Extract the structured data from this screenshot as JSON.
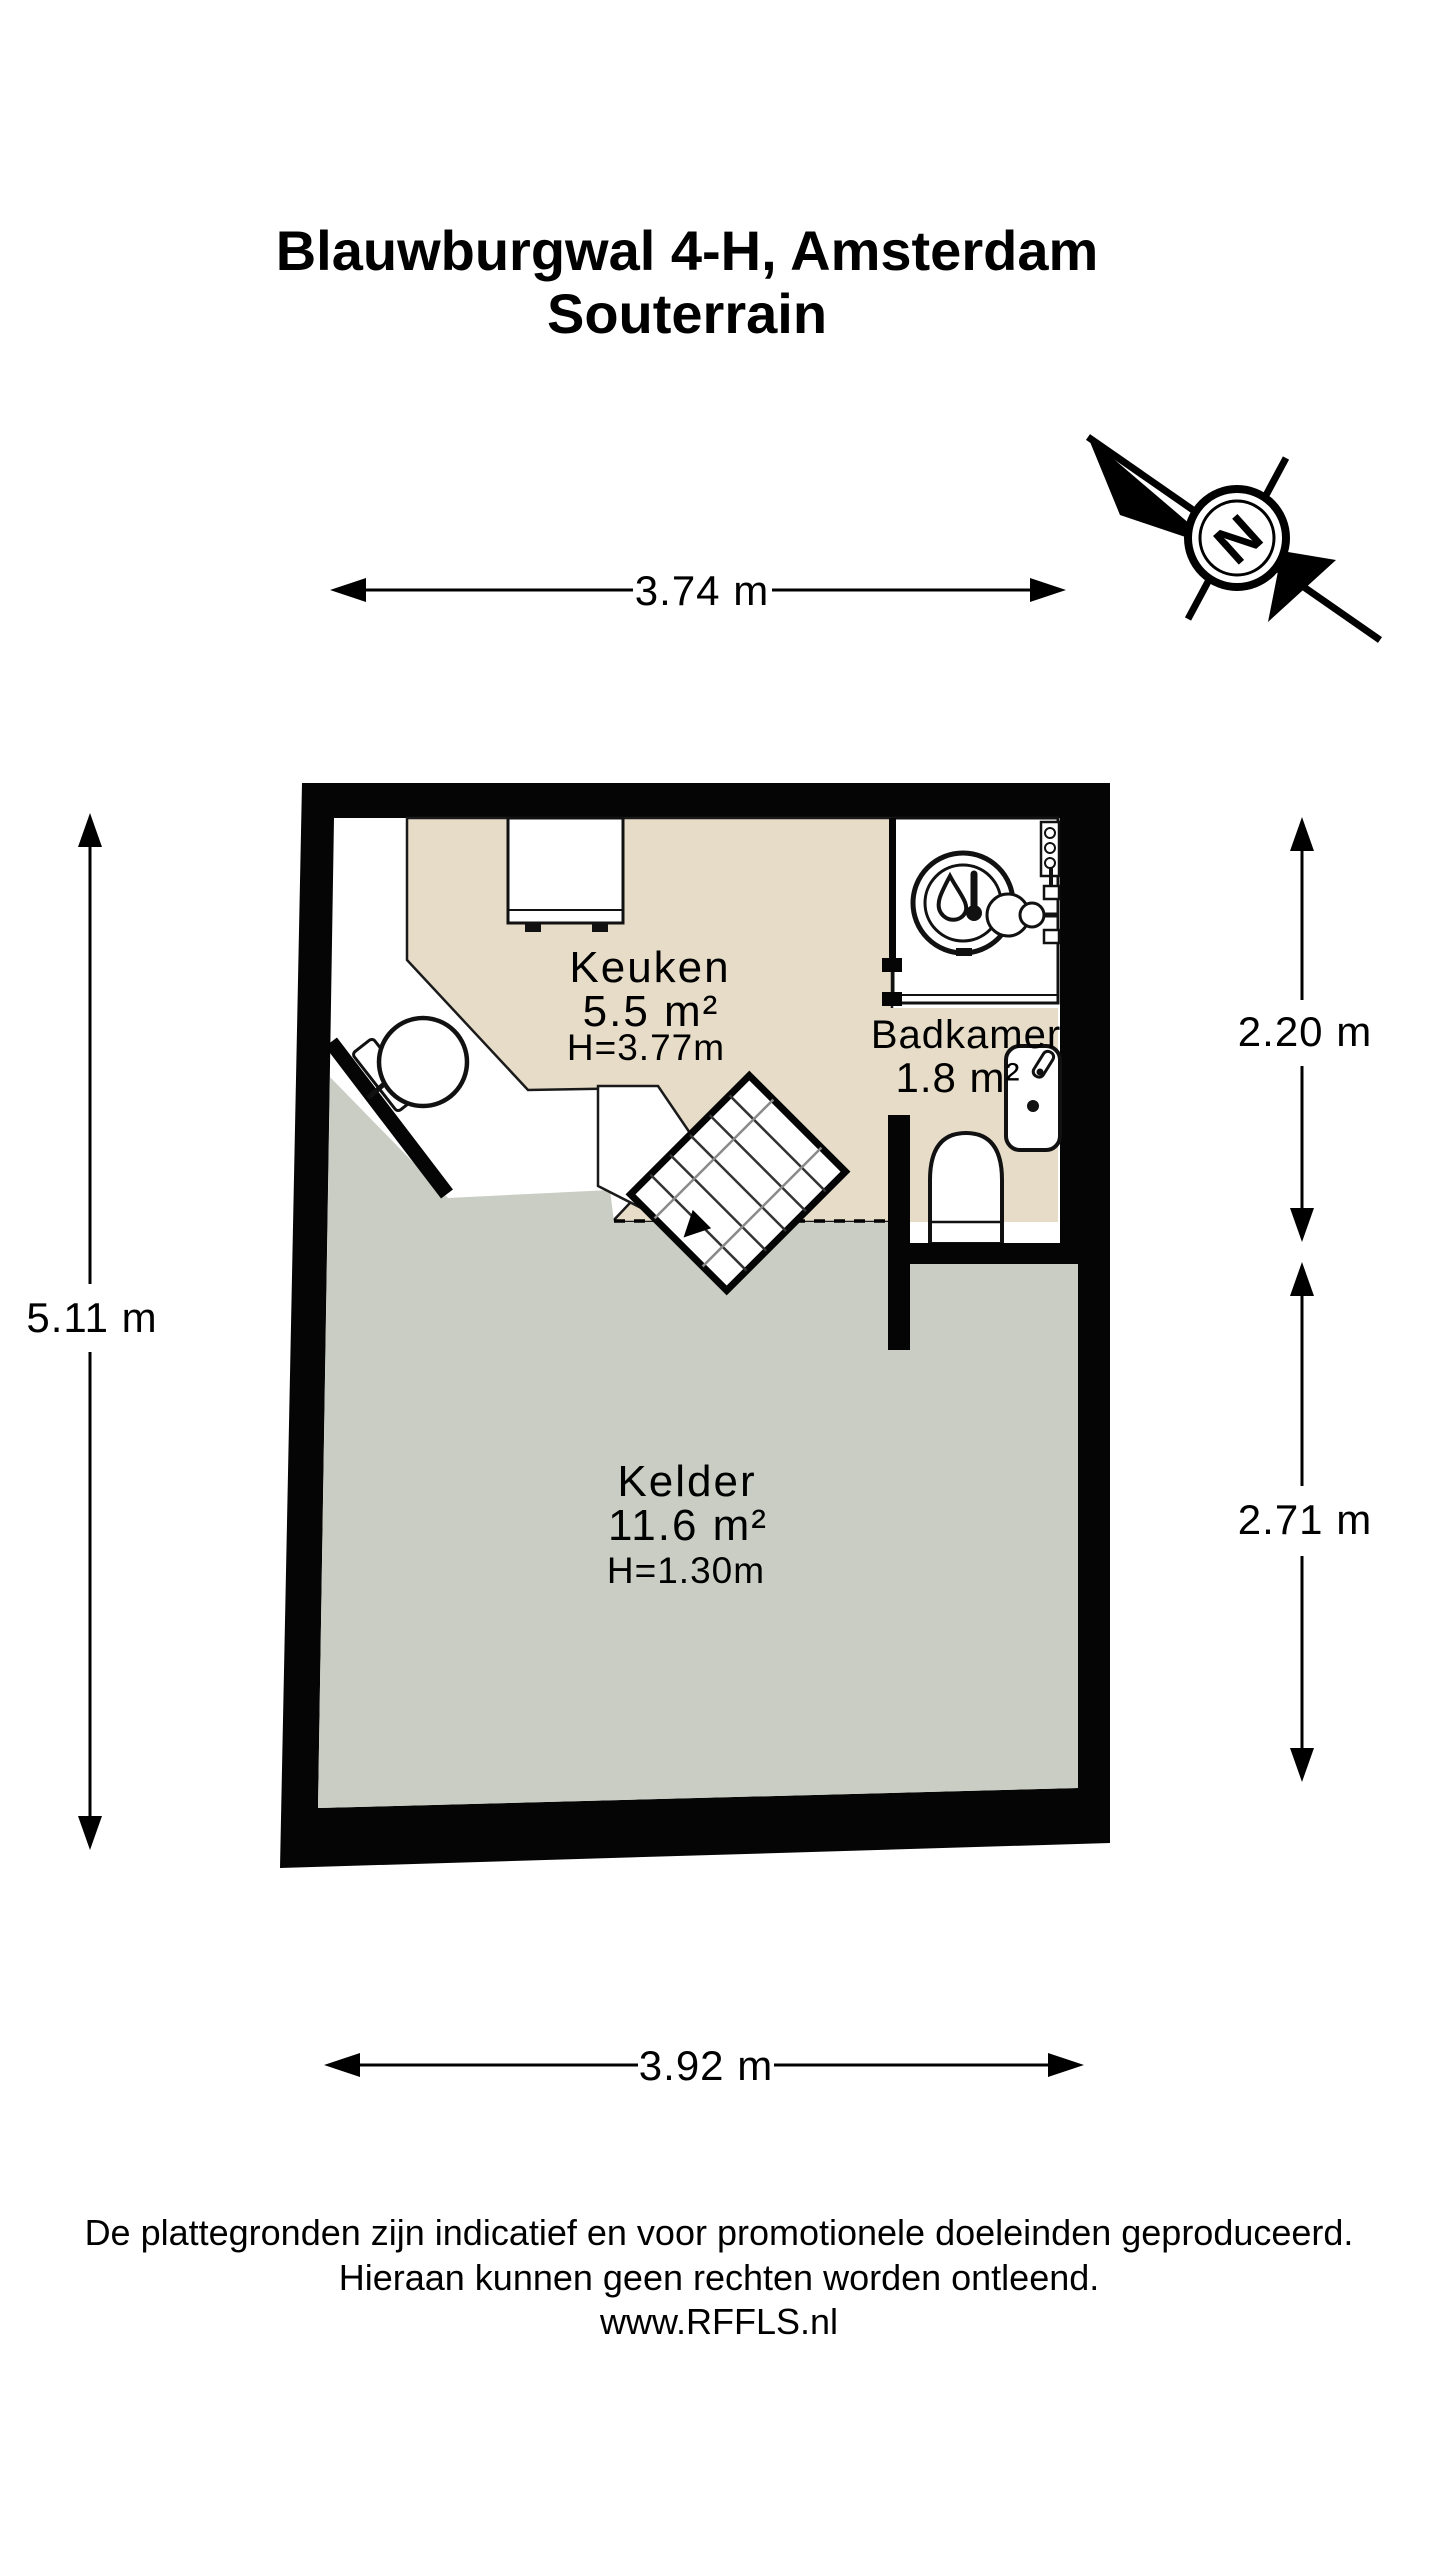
{
  "title": {
    "line1": "Blauwburgwal 4-H, Amsterdam",
    "line2": "Souterrain"
  },
  "compass": {
    "north_label": "N"
  },
  "dimensions": {
    "top": "3.74 m",
    "left": "5.11 m",
    "right_upper": "2.20 m",
    "right_lower": "2.71 m",
    "bottom": "3.92 m"
  },
  "rooms": {
    "keuken": {
      "name": "Keuken",
      "area": "5.5 m²",
      "height": "H=3.77m"
    },
    "badkamer": {
      "name": "Badkamer",
      "area": "1.8 m²"
    },
    "kelder": {
      "name": "Kelder",
      "area": "11.6 m²",
      "height": "H=1.30m"
    }
  },
  "footer": {
    "line1": "De plattegronden zijn indicatief en voor promotionele doeleinden geproduceerd.",
    "line2": "Hieraan kunnen geen rechten worden ontleend.",
    "line3": "www.RFFLS.nl"
  },
  "colors": {
    "wall": "#050505",
    "keuken_floor": "#e6dcc8",
    "badkamer_floor": "#e6dcc8",
    "kelder_floor": "#c9cdc3",
    "step_line": "#8a8a8a",
    "outline": "#111111"
  }
}
